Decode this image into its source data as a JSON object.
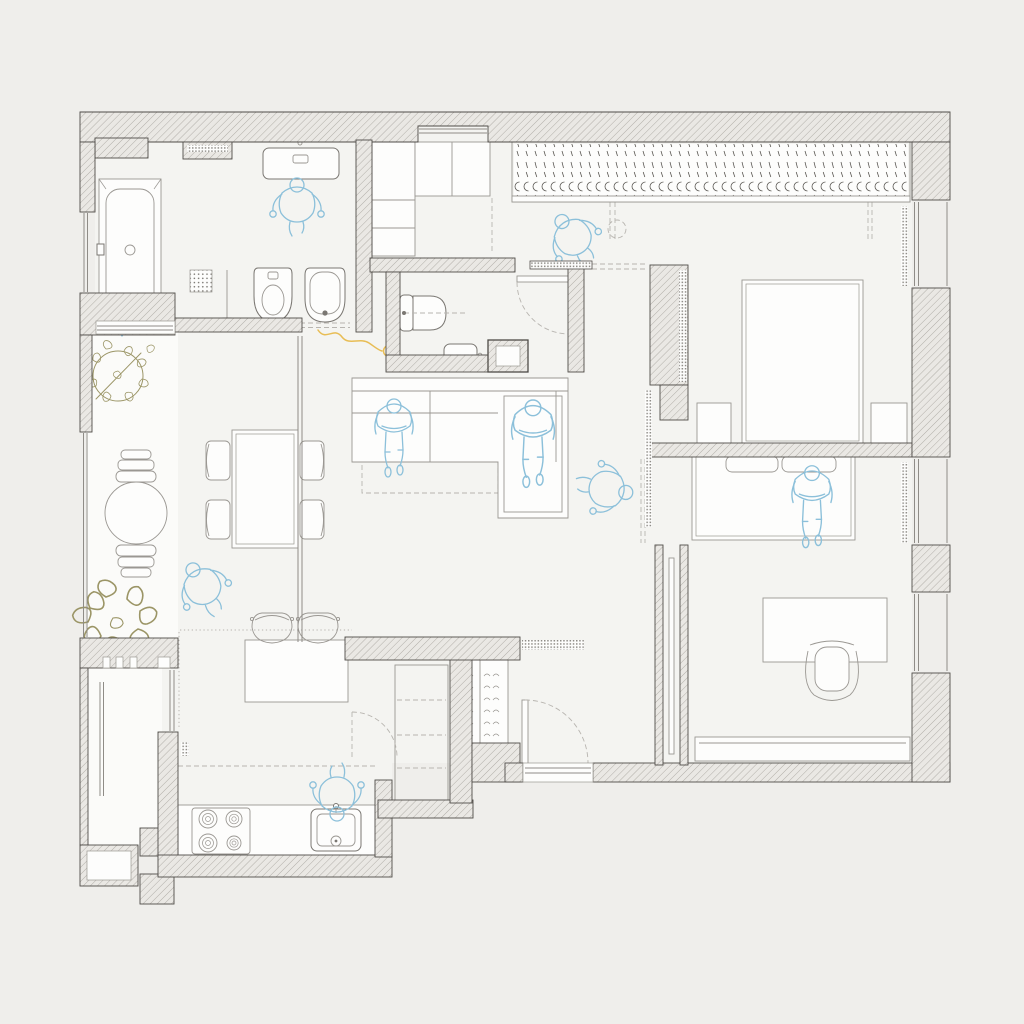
{
  "document": {
    "title": "Apartment floor plan — top view architectural drawing",
    "type": "floor-plan",
    "canvas": {
      "width": 1024,
      "height": 1024
    }
  },
  "colors": {
    "bg": "#efeeeb",
    "floor": "#f4f4f1",
    "balcony": "#fbfbf9",
    "wall_fill": "#eae8e4",
    "wall_hatch": "#a39f99",
    "wall_line": "#4f4c48",
    "furn": "#9a9792",
    "fixture": "#7a7772",
    "dash": "#b8b5b0",
    "glz": "#8f8c87",
    "blind": "#908d88",
    "hanger": "#5a5752",
    "person": "#8cc0da",
    "plant": "#9b9566",
    "cable": "#e8bd55",
    "white": "#fdfdfc"
  },
  "rooms": [
    {
      "name": "bathroom",
      "fixtures": [
        "bathtub",
        "walk-in-shower",
        "shower-glass-screen",
        "washbasin",
        "bidet",
        "toilet",
        "ventilation-grille"
      ]
    },
    {
      "name": "laundry-niche",
      "fixtures": [
        "tall-cabinet",
        "built-in-cabinets",
        "facade-window-niche"
      ]
    },
    {
      "name": "guest-wc",
      "fixtures": [
        "wall-hung-toilet",
        "small-washbasin",
        "service-shaft",
        "swing-door",
        "sliding-door-panel"
      ]
    },
    {
      "name": "hallway",
      "fixtures": [
        "ceiling-light-mark",
        "sliding-door-track",
        "glass-partition-strip"
      ]
    },
    {
      "name": "wardrobe-closet",
      "fixtures": [
        "hanging-rail-sections-x5"
      ]
    },
    {
      "name": "master-bedroom",
      "fixtures": [
        "double-bed",
        "nightstand-left",
        "nightstand-right",
        "window",
        "roller-blind-strip",
        "wall-panel-strip"
      ]
    },
    {
      "name": "kids-room",
      "fixtures": [
        "single-bed",
        "pillow-x2",
        "desk",
        "office-chair",
        "wall-shelf",
        "window-x2",
        "roller-blind-strip",
        "pocket-sliding-door"
      ]
    },
    {
      "name": "living-room",
      "fixtures": [
        "corner-sofa",
        "rug",
        "tv-console"
      ]
    },
    {
      "name": "dining-area",
      "fixtures": [
        "dining-table",
        "chair-x4"
      ]
    },
    {
      "name": "kitchen",
      "fixtures": [
        "peninsula-counter",
        "bar-stool-x2",
        "cooktop-4-burners",
        "kitchen-sink",
        "counter-run",
        "pantry-cabinet",
        "pantry-door",
        "ventilation-grille"
      ]
    },
    {
      "name": "entry",
      "fixtures": [
        "shoe-cabinet",
        "dotted-bench",
        "entrance-door-swing",
        "threshold"
      ]
    },
    {
      "name": "balcony-upper",
      "fixtures": [
        "potted-plant",
        "large-vase",
        "plant-cluster",
        "blue-watering-mark"
      ]
    },
    {
      "name": "balcony-lower",
      "fixtures": [
        "glazing"
      ]
    }
  ],
  "people": [
    {
      "location": "bathroom-washbasin",
      "pose": "standing"
    },
    {
      "location": "hallway",
      "pose": "walking"
    },
    {
      "location": "sofa-left-seat",
      "pose": "sitting"
    },
    {
      "location": "sofa-chaise",
      "pose": "lounging"
    },
    {
      "location": "living-room-east",
      "pose": "standing-arms-out"
    },
    {
      "location": "dining-area",
      "pose": "walking"
    },
    {
      "location": "kitchen-sink",
      "pose": "standing"
    },
    {
      "location": "kids-bed",
      "pose": "lying"
    }
  ],
  "counts": {
    "people": 8,
    "windows": 7,
    "plants": 3,
    "sliding_doors": 3,
    "swing_doors": 3,
    "wardrobe_sections": 5
  }
}
